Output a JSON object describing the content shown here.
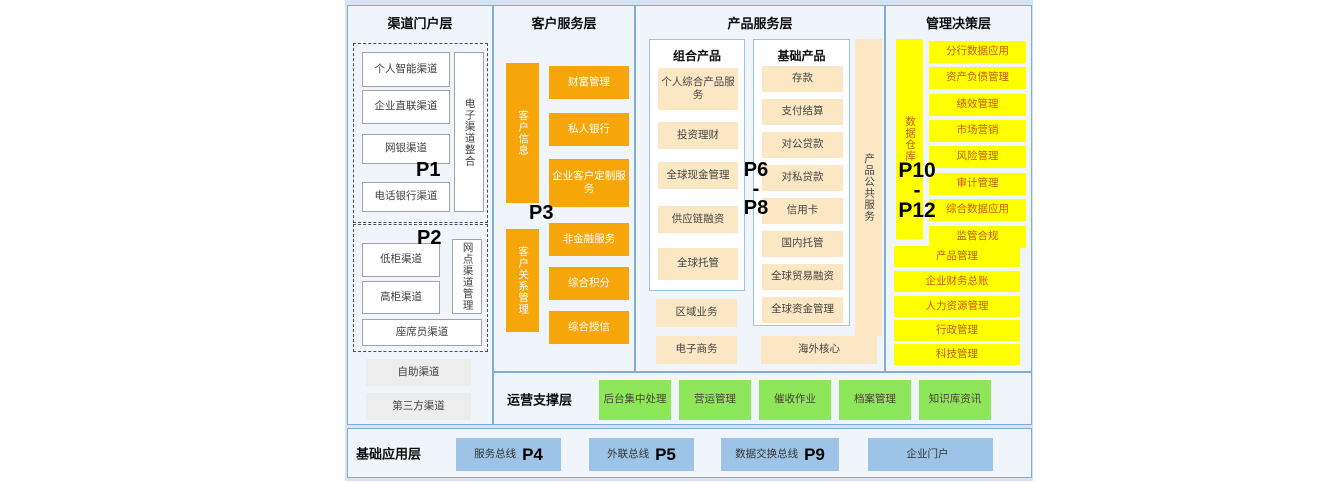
{
  "colors": {
    "canvas_bg": "#d7e3f2",
    "panel_bg": "#f0f5fb",
    "panel_border": "#7facd8",
    "orange": "#f7a60a",
    "cream": "#fbe7c3",
    "yellow": "#ffff00",
    "yellow_text": "#c55a11",
    "green": "#8ee65a",
    "blue_box": "#9dc3e6"
  },
  "layers": {
    "channel": {
      "title": "渠道门户层",
      "p1": "P1",
      "p2": "P2",
      "group1": {
        "items": [
          "个人智能渠道",
          "企业直联渠道",
          "网银渠道",
          "电话银行渠道"
        ],
        "side": "电子渠道整合"
      },
      "group2": {
        "items": [
          "低柜渠道",
          "高柜渠道"
        ],
        "side": "网点渠道管理",
        "wide": "座席员渠道"
      },
      "extras": [
        "自助渠道",
        "第三方渠道"
      ]
    },
    "customer": {
      "title": "客户服务层",
      "p3": "P3",
      "bars": [
        "客户信息",
        "客户关系管理"
      ],
      "items": [
        "财富管理",
        "私人银行",
        "企业客户定制服务",
        "非金融服务",
        "综合积分",
        "综合授信"
      ]
    },
    "product": {
      "title": "产品服务层",
      "p_top": "P6",
      "p_dash": "-",
      "p_bottom": "P8",
      "combo": {
        "title": "组合产品",
        "items": [
          "个人综合产品服务",
          "投资理财",
          "全球现金管理",
          "供应链融资",
          "全球托管"
        ]
      },
      "basic": {
        "title": "基础产品",
        "items": [
          "存款",
          "支付结算",
          "对公贷款",
          "对私贷款",
          "信用卡",
          "国内托管",
          "全球贸易融资",
          "全球资金管理"
        ]
      },
      "side": "产品公共服务",
      "extras": [
        "区域业务",
        "电子商务"
      ],
      "overseas": "海外核心"
    },
    "management": {
      "title": "管理决策层",
      "p_top": "P10",
      "p_dash": "-",
      "p_bottom": "P12",
      "bar": "数据仓库",
      "items": [
        "分行数据应用",
        "资产负债管理",
        "绩效管理",
        "市场营销",
        "风险管理",
        "审计管理",
        "综合数据应用",
        "监管合规"
      ],
      "wide_items": [
        "产品管理",
        "企业财务总账",
        "人力资源管理",
        "行政管理",
        "科技管理"
      ]
    },
    "operation": {
      "title": "运营支撑层",
      "items": [
        "后台集中处理",
        "营运管理",
        "催收作业",
        "档案管理",
        "知识库资讯"
      ]
    },
    "foundation": {
      "title": "基础应用层",
      "items": [
        {
          "label": "服务总线",
          "p": "P4"
        },
        {
          "label": "外联总线",
          "p": "P5"
        },
        {
          "label": "数据交换总线",
          "p": "P9"
        },
        {
          "label": "企业门户",
          "p": ""
        }
      ]
    }
  }
}
